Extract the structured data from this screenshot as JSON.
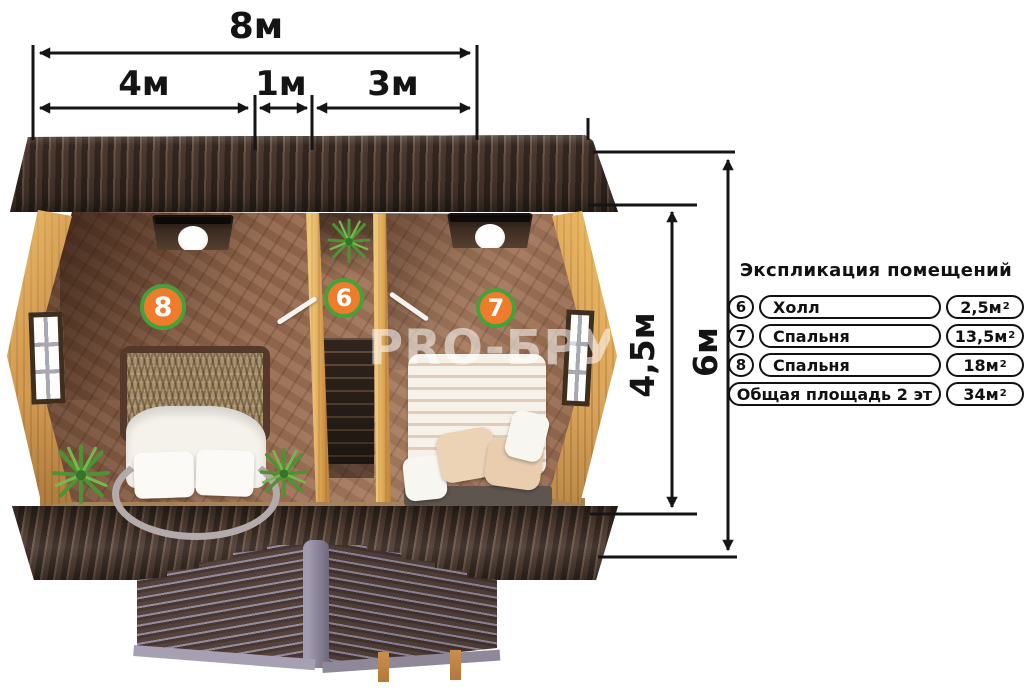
{
  "dimensions": {
    "width_total": "8м",
    "width_left": "4м",
    "width_middle": "1м",
    "width_right": "3м",
    "height_inner": "4,5м",
    "height_outer": "6м"
  },
  "badges": {
    "bedroom_left": "8",
    "hall": "6",
    "bedroom_right": "7"
  },
  "watermark": "PRO-БРУС",
  "legend": {
    "title": "Экспликация помещений",
    "rows": [
      {
        "num": "6",
        "name": "Холл",
        "area": "2,5м",
        "sup": "2"
      },
      {
        "num": "7",
        "name": "Спальня",
        "area": "13,5м",
        "sup": "2"
      },
      {
        "num": "8",
        "name": "Спальня",
        "area": "18м",
        "sup": "2"
      },
      {
        "num": "",
        "name": "Общая площадь 2 эт",
        "area": "34м",
        "sup": "2"
      }
    ]
  },
  "colors": {
    "badge_fill": "#ee7c2b",
    "badge_ring": "#45a13c",
    "dimension_line": "#151515",
    "roof_brown": "#463227",
    "wall_tan": "#d39a52",
    "floor_brown": "#9c6e52",
    "first_floor_gray": "#877f93"
  }
}
